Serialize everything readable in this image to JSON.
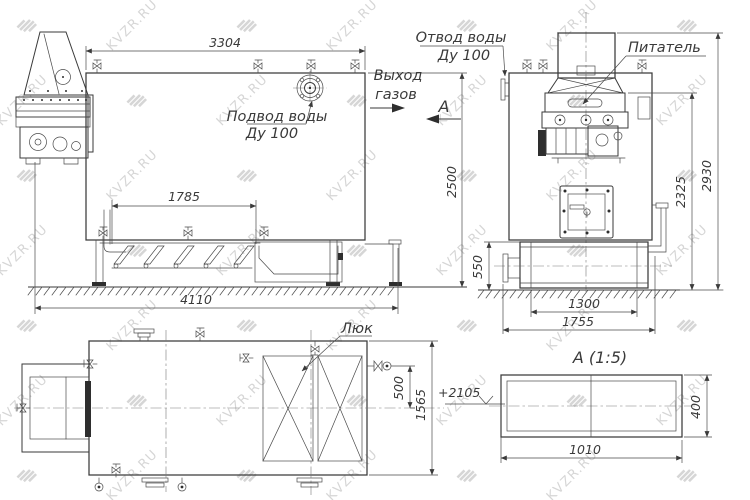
{
  "watermark": {
    "text": "KVZR.RU"
  },
  "drawing": {
    "labels": {
      "water_inlet_line1": "Подвод воды",
      "water_inlet_line2": "Ду 100",
      "water_outlet_line1": "Отвод воды",
      "water_outlet_line2": "Ду 100",
      "gas_exit_line1": "Выход",
      "gas_exit_line2": "газов",
      "feeder": "Питатель",
      "hatch": "Люк",
      "section_arrow_letter": "А",
      "section_title": "А (1:5)",
      "elevation_mark": "+2105"
    },
    "dimensions": {
      "boiler_top_length": "3304",
      "grate_length": "1785",
      "overall_length": "4110",
      "boiler_height": "2500",
      "ash_box_height": "550",
      "ash_box_width": "1300",
      "front_width": "1755",
      "feeder_level_height": "2325",
      "overall_height": "2930",
      "plan_depth": "1565",
      "valve_offset": "500",
      "duct_length": "1010",
      "duct_height": "400"
    }
  }
}
